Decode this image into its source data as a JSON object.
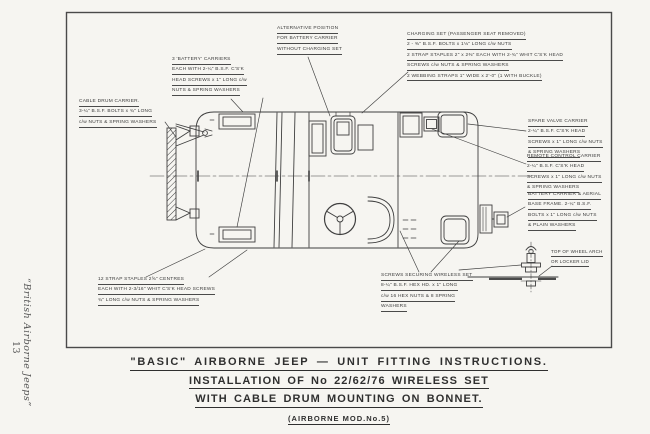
{
  "page": {
    "margin_caption": "“British Airborne Jeeps”",
    "page_number": "13"
  },
  "title_block": {
    "line1": "\"BASIC\" AIRBORNE JEEP — UNIT FITTING INSTRUCTIONS.",
    "line2": "INSTALLATION OF  No 22/62/76 WIRELESS SET",
    "line3": "WITH CABLE DRUM MOUNTING ON BONNET.",
    "line4": "(AIRBORNE MOD.No.5)"
  },
  "labels": [
    {
      "id": "alternative-position",
      "lines": [
        "ALTERNATIVE POSITION",
        "FOR BATTERY CARRIER",
        "WITHOUT CHARGING SET"
      ]
    },
    {
      "id": "battery-carriers",
      "lines": [
        "3 'BATTERY' CARRIERS",
        "EACH WITH 2-¼\" B.S.F. C'S'K",
        "HEAD SCREWS x 1\" LONG c/w",
        "NUTS & SPRING WASHERS"
      ]
    },
    {
      "id": "cable-drum-carrier",
      "lines": [
        "CABLE DRUM CARRIER.",
        "3-¼\" B.S.F. BOLTS x ¾\" LONG",
        "c/w NUTS & SPRING WASHERS"
      ]
    },
    {
      "id": "charging-set",
      "lines": [
        "CHARGING SET (PASSENGER SEAT REMOVED)",
        "2 - ⅜\" B.S.F. BOLTS x 1⅛\" LONG c/w NUTS",
        "2 STRAP STAPLES 2\" x 2⅜\" EACH WITH 2-¾\" WHIT C'S'K HEAD",
        "SCREWS c/w NUTS & SPRING WASHERS",
        "2 WEBBING STRAPS 1\" WIDE x 2'-0\" (1 WITH BUCKLE)"
      ]
    },
    {
      "id": "spare-valve-carrier",
      "lines": [
        "SPARE VALVE CARRIER",
        "2-¼\" B.S.F. C'S'K HEAD",
        "SCREWS x 1\" LONG c/w NUTS",
        "& SPRING WASHERS"
      ]
    },
    {
      "id": "remote-control-carrier",
      "lines": [
        "REMOTE CONTROL CARRIER",
        "2-¼\" B.S.F. C'S'K HEAD",
        "SCREWS x 1\" LONG c/w NUTS",
        "& SPRING WASHERS"
      ]
    },
    {
      "id": "battery-carrier-aerial",
      "lines": [
        "BATTERY CARRIER & AERIAL",
        "BASE FRAME. 2-¼\" B.S.F.",
        "BOLTS x 1\" LONG c/w NUTS",
        "& PLAIN WASHERS"
      ]
    },
    {
      "id": "screws-securing-wireless",
      "lines": [
        "SCREWS SECURING WIRELESS SET",
        "8-¼\" B.S.F. HEX HD. x 1\" LONG",
        "c/w 16 HEX NUTS & 8 SPRING",
        "WASHERS"
      ]
    },
    {
      "id": "wheel-arch",
      "lines": [
        "TOP OF WHEEL ARCH",
        "OR LOCKER LID"
      ]
    },
    {
      "id": "strap-staples",
      "lines": [
        "12 STRAP STAPLES 2⅝\" CENTRES",
        "EACH WITH 2-3/16\" WHIT C'S'K HEAD SCREWS",
        "¾\" LONG c/w NUTS & SPRING WASHERS"
      ]
    }
  ],
  "colors": {
    "ink": "#3f3f3f",
    "paper": "#f6f5f1"
  }
}
